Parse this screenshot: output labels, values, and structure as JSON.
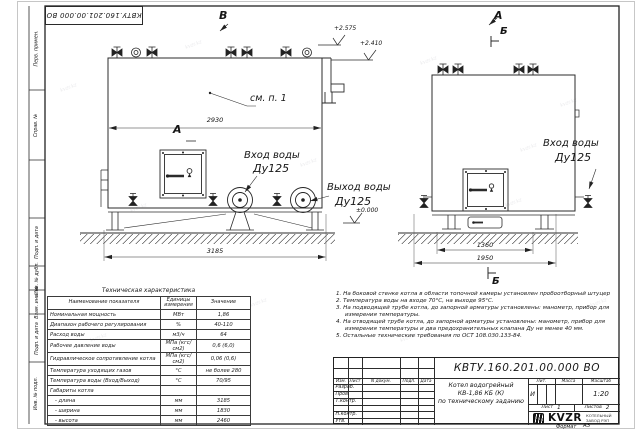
{
  "doc": {
    "stamp": "КВТУ.160.201.00.000 ВО",
    "number": "КВТУ.160.201.00.000  ВО",
    "format_label": "Формат",
    "format_value": "А3"
  },
  "frame_strip": {
    "cells": [
      "Перв. примен.",
      "Справ. №",
      "Подп. и дата",
      "Инв. № дубл.",
      "Взам. инв. №",
      "Подп. и дата",
      "Инв. № подл."
    ]
  },
  "drawing": {
    "view_label_a": "А",
    "view_label_b": "В",
    "section_label": "Б",
    "callout": "см. п. 1",
    "dim_front_width": "2930",
    "dim_front_length": "3185",
    "dim_side_inner": "1360",
    "dim_side_outer": "1950",
    "elev_top": "+2.575",
    "elev_flange": "+2.410",
    "elev_ground": "±0.000",
    "inlet_label": "Вход воды",
    "outlet_label": "Выход воды",
    "dn_label": "Ду125"
  },
  "tech_table": {
    "title": "Техническая характеристика",
    "col_name": "Наименование показателя",
    "col_units": "Единицы измерения",
    "col_value": "Значение",
    "rows": [
      {
        "n": "Номинальная мощность",
        "u": "МВт",
        "v": "1,86"
      },
      {
        "n": "Диапазон рабочего регулирования",
        "u": "%",
        "v": "40-110"
      },
      {
        "n": "Расход воды",
        "u": "м3/ч",
        "v": "64"
      },
      {
        "n": "Рабочее давление воды",
        "u": "МПа (кгс/см2)",
        "v": "0,6 (6,0)"
      },
      {
        "n": "Гидравлическое сопротивление котла",
        "u": "МПа (кгс/см2)",
        "v": "0,06 (0,6)"
      },
      {
        "n": "Температура уходящих газов",
        "u": "°С",
        "v": "не более 280"
      },
      {
        "n": "Температура воды (Вход/Выход)",
        "u": "°С",
        "v": "70/95"
      },
      {
        "n": "Габариты котла",
        "u": "",
        "v": ""
      },
      {
        "n": "   - длина",
        "u": "мм",
        "v": "3185"
      },
      {
        "n": "   - ширина",
        "u": "мм",
        "v": "1830"
      },
      {
        "n": "   - высота",
        "u": "мм",
        "v": "2460"
      }
    ]
  },
  "notes": [
    "1.  На боковой стенке котла в области топочной камеры установлен пробоотборный штуцер",
    "2.  Температура воды на входе 70°С, на выходе 95°С.",
    "3.  На подводящей трубе котла, до запорной арматуры установлены: манометр, прибор для измерения температуры.",
    "4.  На отводящей трубе котла, до запорной арматуры установлены: манометр, прибор для измерения температуры и два предохранительных клапана Ду не менее 40 мм.",
    "5.  Остальные технические требования по ОСТ 108.030.133-84."
  ],
  "title_block": {
    "rev_cols": {
      "izm": "Изм.",
      "list": "Лист",
      "doc": "N докум.",
      "podp": "Подп.",
      "data": "Дата"
    },
    "roles": [
      "Разраб.",
      "Пров.",
      "Т.контр.",
      "Н.контр.",
      "Утв."
    ],
    "product_name_1": "Котел водогрейный",
    "product_name_2": "КВ-1,86  КБ  (К)",
    "product_name_3": "по техническому заданию",
    "lit_header": "Лит.",
    "lit_value": "И",
    "mass_header": "Масса",
    "scale_header": "Масштаб",
    "scale_value": "1:20",
    "sheet_label": "Лист",
    "sheet_value": "1",
    "sheets_label": "Листов",
    "sheets_value": "2",
    "company": "KVZR",
    "company_line1": "КОТЕЛЬНЫЙ",
    "company_line2": "ЗАВОД РЭП"
  },
  "watermark": "kvzr.kz"
}
